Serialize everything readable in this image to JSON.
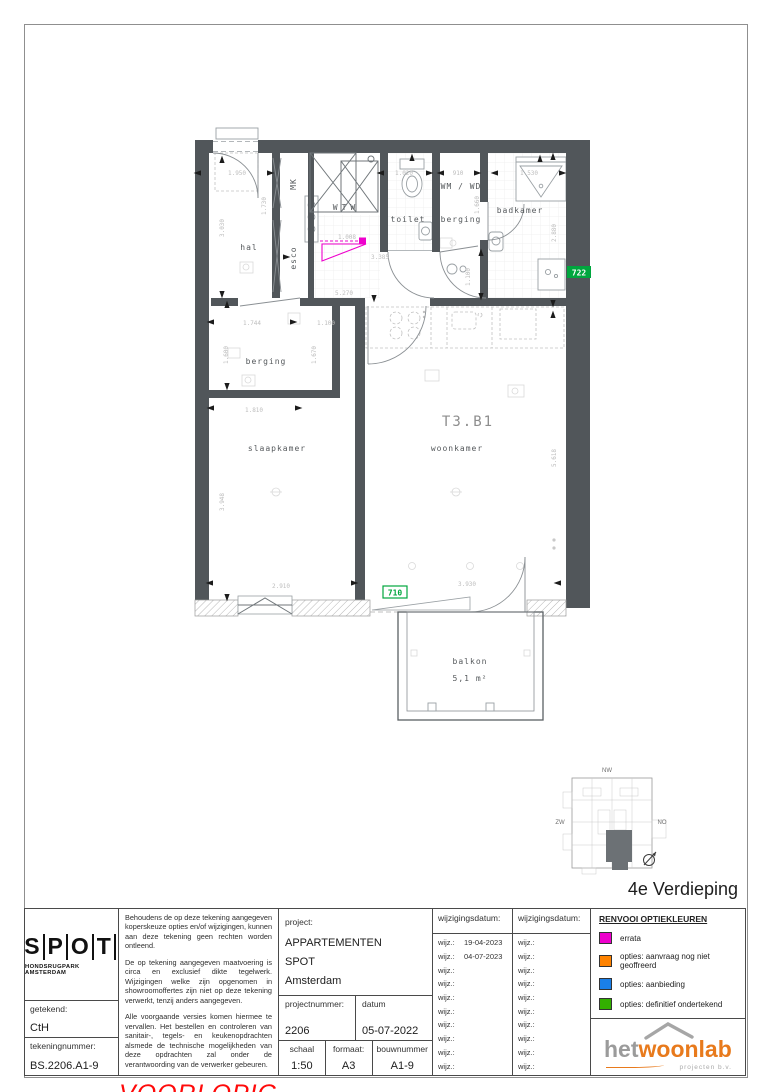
{
  "colors": {
    "wall": "#51565a",
    "errata": "#ee00cc",
    "tag_green": "#00a63e",
    "stamp_red": "#ff0a0a",
    "brand_orange": "#e87a1c",
    "brand_gray": "#9b9b9b"
  },
  "plan": {
    "unit_label": "T3.B1",
    "labels": {
      "hal": "hal",
      "mk": "MK",
      "esco": "esco",
      "wtw": "WTW",
      "toilet": "toilet",
      "wm_wd": "WM / WD",
      "berging_top": "berging",
      "badkamer": "badkamer",
      "berging_mid": "berging",
      "slaapkamer": "slaapkamer",
      "woonkamer": "woonkamer",
      "balkon": "balkon",
      "balkon_area": "5,1  m²"
    },
    "option_tags": {
      "badkamer": "722",
      "balkon": "710"
    },
    "dimensions": [
      "1.950",
      "3.030",
      "1.730",
      "1.020",
      "910",
      "1.530",
      "1.660",
      "2.880",
      "1.008",
      "3.385",
      "5.270",
      "1.744",
      "1.100",
      "1.100",
      "1.600",
      "1.670",
      "1.810",
      "3.948",
      "5.618",
      "2.910",
      "3.930"
    ],
    "keyplan": {
      "nw": "NW",
      "zw": "ZW",
      "no": "NO",
      "zo": "ZO"
    },
    "floor_label": "4e Verdieping"
  },
  "titleblock": {
    "logo": {
      "letters": [
        "S",
        "P",
        "O",
        "T"
      ],
      "subtitle": "HONDSRUGPARK AMSTERDAM"
    },
    "getekend_label": "getekend:",
    "getekend_value": "CtH",
    "tekeningnummer_label": "tekeningnummer:",
    "tekeningnummer_value": "BS.2206.A1-9",
    "disclaimer": [
      "Behoudens de op deze tekening aangegeven koperskeuze opties en/of wijzigingen, kunnen aan deze tekening geen rechten worden ontleend.",
      "De op tekening aangegeven maatvoering is circa en exclusief dikte tegelwerk. Wijzigingen welke zijn opgenomen in showroomoffertes zijn niet op deze tekening verwerkt, tenzij anders aangegeven.",
      "Alle voorgaande versies komen hiermee te vervallen. Het bestellen en controleren van sanitair-, tegels- en keukenopdrachten alsmede de technische mogelijkheden van deze opdrachten zal onder de verantwoording van de verwerker gebeuren."
    ],
    "stamp": "VOORLOPIG",
    "project_label": "project:",
    "project_lines": [
      "APPARTEMENTEN",
      "SPOT",
      "Amsterdam"
    ],
    "projectnummer_label": "projectnummer:",
    "projectnummer_value": "2206",
    "datum_label": "datum",
    "datum_value": "05-07-2022",
    "schaal_label": "schaal",
    "schaal_value": "1:50",
    "formaat_label": "formaat:",
    "formaat_value": "A3",
    "bouwnummer_label": "bouwnummer",
    "bouwnummer_value": "A1-9",
    "wijzigingsdatum_label": "wijzigingsdatum:",
    "wijz_label": "wijz.:",
    "wijz_col1": [
      "19-04-2023",
      "04-07-2023",
      "",
      "",
      "",
      "",
      "",
      "",
      "",
      ""
    ],
    "wijz_col2": [
      "",
      "",
      "",
      "",
      "",
      "",
      "",
      "",
      "",
      ""
    ],
    "renvooi": {
      "title": "RENVOOI OPTIEKLEUREN",
      "items": [
        {
          "color": "#ee00cc",
          "label": "errata"
        },
        {
          "color": "#ff8300",
          "label": "opties: aanvraag nog niet geoffreerd"
        },
        {
          "color": "#1a7fe8",
          "label": "opties: aanbieding"
        },
        {
          "color": "#33b000",
          "label": "opties: definitief ondertekend"
        }
      ]
    },
    "vendor": {
      "part1": "het",
      "part2": "woonlab",
      "tagline": "projecten b.v."
    }
  }
}
